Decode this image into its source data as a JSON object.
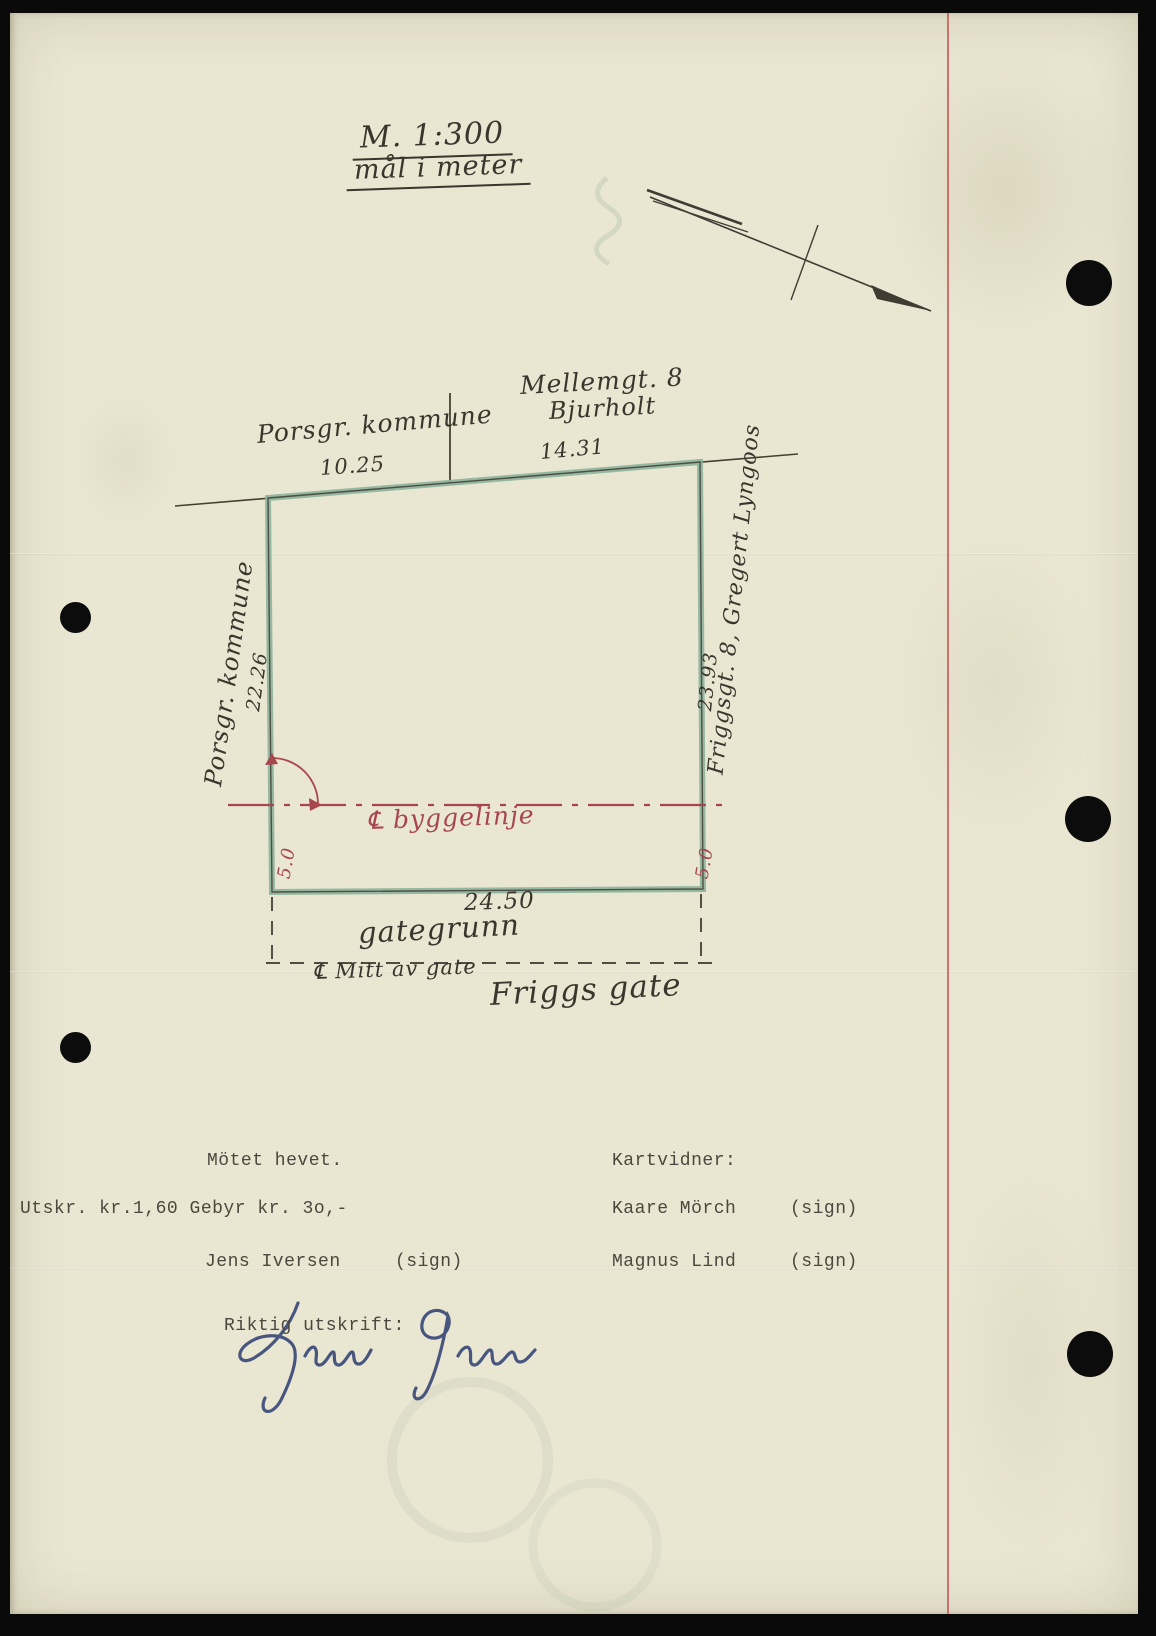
{
  "scale": {
    "line1": "M. 1:300",
    "line2": "mål i meter"
  },
  "plot": {
    "top_owner": "Porsgr. kommune",
    "top_dim_left": "10.25",
    "top_neighbor_line1": "Mellemgt. 8",
    "top_neighbor_line2": "Bjurholt",
    "top_dim_right": "14.31",
    "left_owner": "Porsgr. kommune",
    "left_dim": "22.26",
    "right_dim": "23.93",
    "right_neighbor": "Friggsgt. 8, Gregert Lyngoos",
    "building_line_label": "℄ byggelinje",
    "setback_left": "5.0",
    "setback_right": "5.0",
    "bottom_dim": "24.50",
    "street_ground_label": "gategrunn",
    "street_mid_label": "℄ Mitt av gate",
    "street_name": "Friggs gate"
  },
  "minutes": {
    "closed": "Mötet hevet.",
    "witnesses_heading": "Kartvidner:",
    "fee_line": "Utskr. kr.1,60 Gebyr kr. 3o,-",
    "witness1_name": "Kaare Mörch",
    "witness1_sign": "(sign)",
    "recorder_name": "Jens Iversen",
    "recorder_sign": "(sign)",
    "witness2_name": "Magnus Lind",
    "witness2_sign": "(sign)",
    "certify_label": "Riktig utskrift:"
  },
  "colors": {
    "paper": "#e9e6d2",
    "ink": "#3a362e",
    "parcel_green": "#8db29a",
    "map_red": "#a8464e",
    "margin_red": "#c65555",
    "signature_blue": "#3b4a78"
  }
}
